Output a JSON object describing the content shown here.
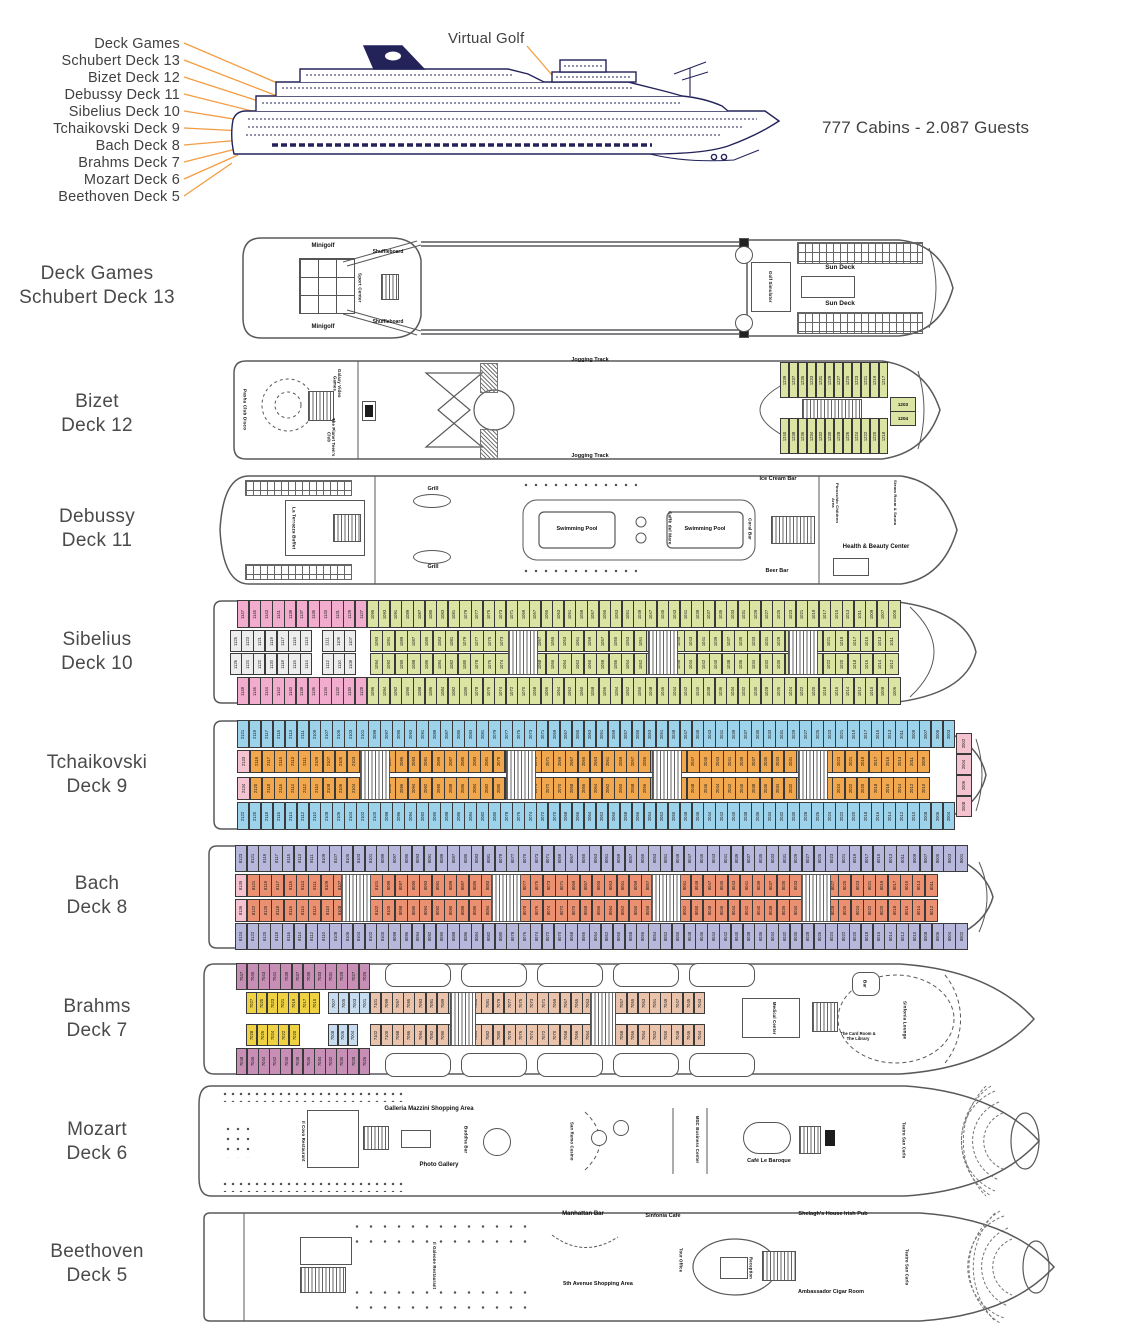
{
  "profile": {
    "virtual_golf": "Virtual Golf",
    "capacity": "777 Cabins - 2.087 Guests",
    "callouts": [
      "Deck Games",
      "Schubert Deck 13",
      "Bizet Deck 12",
      "Debussy Deck 11",
      "Sibelius Deck 10",
      "Tchaikovski Deck 9",
      "Bach Deck 8",
      "Brahms Deck 7",
      "Mozart Deck 6",
      "Beethoven Deck 5"
    ]
  },
  "colors": {
    "navy": "#23235A",
    "leader_orange": "#F49C42",
    "cabin_green": "#DBE4A2",
    "cabin_pink": "#F2ADCE",
    "cabin_gray": "#EDEDED",
    "cabin_blue": "#9DD2EB",
    "cabin_orange": "#F1A74E",
    "cabin_lavender": "#B7B7DB",
    "cabin_salmon": "#EB9171",
    "cabin_mauve": "#C78FB5",
    "cabin_yellow": "#EFD244",
    "cabin_ltblue": "#C7DCEE",
    "cabin_beige": "#EAC3AD",
    "cabin_rose": "#F5C3D0"
  },
  "decks": {
    "d13": {
      "name": [
        "Deck Games",
        "Schubert Deck 13"
      ],
      "labels": {
        "minigolf_top": "Minigolf",
        "minigolf_bot": "Minigolf",
        "sport": "Sport Center",
        "shuffle_top": "Shuffleboard",
        "shuffle_bot": "Shuffleboard",
        "sun_top": "Sun Deck",
        "sun_bot": "Sun Deck",
        "golfsim": "Golf Simulator"
      }
    },
    "d12": {
      "name": [
        "Bizet",
        "Deck 12"
      ],
      "labels": {
        "pasha": "Pasha Club Disco",
        "galaxy": "Galaxy Video Games",
        "planet": "The Planet Teen's Club",
        "jog_top": "Jogging Track",
        "jog_bot": "Jogging Track",
        "c1203": "1203",
        "c1204": "1204"
      },
      "bands": {
        "top": {
          "count": 12,
          "color": "#DBE4A2",
          "start": 1239,
          "step": -2
        },
        "bottom": {
          "count": 12,
          "color": "#DBE4A2",
          "start": 1240,
          "step": -2
        }
      }
    },
    "d11": {
      "name": [
        "Debussy",
        "Deck 11"
      ],
      "labels": {
        "terrazza": "La Terrazza Buffet",
        "grill_top": "Grill",
        "grill_bot": "Grill",
        "caffe": "Caffè del Mare",
        "pool1": "Swimming Pool",
        "pool2": "Swimming Pool",
        "ice": "Ice Cream Bar",
        "coral": "Coral Bar",
        "beer": "Beer Bar",
        "health": "Health & Beauty Center",
        "pinocchio": "Pinocchio Children Area",
        "steam": "Steam Room & Sauna"
      }
    },
    "d10": {
      "name": [
        "Sibelius",
        "Deck 10"
      ],
      "bands": {
        "pink_t": {
          "count": 11,
          "color": "#F2ADCE",
          "start": 1147,
          "step": -2
        },
        "pink_b": {
          "count": 11,
          "color": "#F2ADCE",
          "start": 1148,
          "step": -2
        },
        "gray_t1": {
          "count": 7,
          "color": "#EDEDED",
          "start": 1125,
          "step": -2
        },
        "gray_t2": {
          "count": 3,
          "color": "#EDEDED",
          "start": 1111,
          "step": -2
        },
        "gray_b1": {
          "count": 7,
          "color": "#EDEDED",
          "start": 1126,
          "step": -2
        },
        "gray_b2": {
          "count": 3,
          "color": "#EDEDED",
          "start": 1112,
          "step": -2
        },
        "green_ot": {
          "count": 46,
          "color": "#DBE4A2",
          "start": 1095,
          "step": -2
        },
        "green_it": {
          "count": 42,
          "color": "#DBE4A2",
          "start": 1093,
          "step": -2
        },
        "green_ib": {
          "count": 42,
          "color": "#DBE4A2",
          "start": 1094,
          "step": -2
        },
        "green_ob": {
          "count": 46,
          "color": "#DBE4A2",
          "start": 1096,
          "step": -2
        }
      }
    },
    "d9": {
      "name": [
        "Tchaikovski",
        "Deck 9"
      ],
      "bands": {
        "blue_t": {
          "count": 60,
          "color": "#9DD2EB",
          "start": 2121,
          "step": -2
        },
        "blue_b": {
          "count": 60,
          "color": "#9DD2EB",
          "start": 2122,
          "step": -2
        },
        "or_t": {
          "count": 56,
          "color": "#F1A74E",
          "start": 2119,
          "step": -2
        },
        "or_b": {
          "count": 56,
          "color": "#F1A74E",
          "start": 2120,
          "step": -2
        },
        "pink_lt": {
          "count": 1,
          "color": "#F5C3D0",
          "start": 2133,
          "step": -2
        },
        "pink_lb": {
          "count": 1,
          "color": "#F5C3D0",
          "start": 2134,
          "step": -2
        },
        "bow": {
          "count": 4,
          "color": "#F5C3D0",
          "start": 2002,
          "step": 2,
          "dir": "col"
        }
      }
    },
    "d8": {
      "name": [
        "Bach",
        "Deck 8"
      ],
      "bands": {
        "lav_t": {
          "count": 62,
          "color": "#B7B7DB",
          "start": 8123,
          "step": -2
        },
        "lav_b": {
          "count": 62,
          "color": "#B7B7DB",
          "start": 8124,
          "step": -2
        },
        "sal_t": {
          "count": 56,
          "color": "#EB9171",
          "start": 8121,
          "step": -2
        },
        "sal_b": {
          "count": 56,
          "color": "#EB9171",
          "start": 8122,
          "step": -2
        },
        "rose_t": {
          "count": 1,
          "color": "#F5C3D0",
          "start": 8135,
          "step": -2
        },
        "rose_b": {
          "count": 1,
          "color": "#F5C3D0",
          "start": 8136,
          "step": -2
        }
      }
    },
    "d7": {
      "name": [
        "Brahms",
        "Deck 7"
      ],
      "labels": {
        "bar": "Bar",
        "medical": "Medical Center",
        "card": "The Card Room & The Library",
        "lounge": "Sinfonia Lounge"
      },
      "bands": {
        "mauve_t": {
          "count": 12,
          "color": "#C78FB5",
          "start": 7047,
          "step": -2
        },
        "mauve_b": {
          "count": 12,
          "color": "#C78FB5",
          "start": 7048,
          "step": -2
        },
        "yel_t": {
          "count": 7,
          "color": "#EFD244",
          "start": 7027,
          "step": -2
        },
        "yel_b": {
          "count": 5,
          "color": "#EFD244",
          "start": 7028,
          "step": -2
        },
        "blu_t": {
          "count": 4,
          "color": "#C7DCEE",
          "start": 7007,
          "step": -2
        },
        "blu_b": {
          "count": 3,
          "color": "#C7DCEE",
          "start": 7008,
          "step": -2
        },
        "bei_t": {
          "count": 30,
          "color": "#EAC3AD",
          "start": 7101,
          "step": -2
        },
        "bei_b": {
          "count": 30,
          "color": "#EAC3AD",
          "start": 7102,
          "step": -2
        }
      }
    },
    "d6": {
      "name": [
        "Mozart",
        "Deck 6"
      ],
      "labels": {
        "ilcovo": "Il Covo Restaurant",
        "galleria": "Galleria Mazzini Shopping Area",
        "photo": "Photo Gallery",
        "buddha": "Buddha Bar",
        "casino": "San Remo Casino",
        "msc": "MSC Business Center",
        "baroque": "Café Le Baroque",
        "teatro": "Teatro San Carlo"
      }
    },
    "d5": {
      "name": [
        "Beethoven",
        "Deck 5"
      ],
      "labels": {
        "galeone": "Il Galeone Restaurant",
        "manhattan": "Manhattan Bar",
        "avenue": "5th Avenue Shopping Area",
        "scafe": "Sinfonia Cafè",
        "tour": "Tour Office",
        "reception": "Reception",
        "irish": "Shelagh's House Irish Pub",
        "cigar": "Ambassador Cigar Room",
        "teatro": "Teatro San Carlo"
      }
    }
  }
}
